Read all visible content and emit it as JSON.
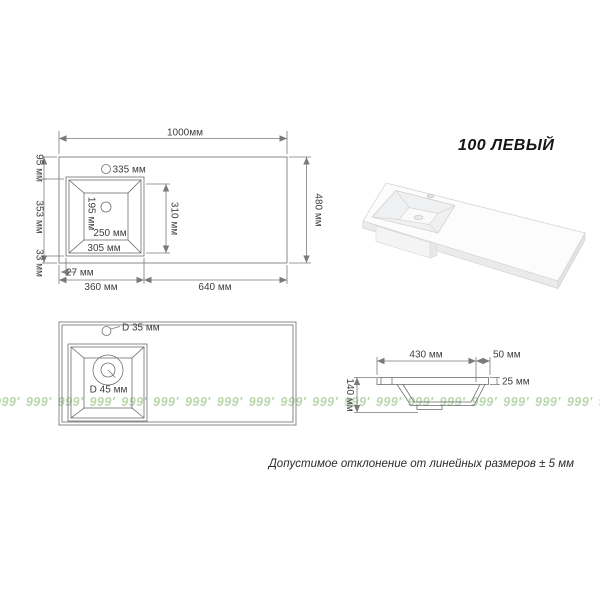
{
  "title": "100 ЛЕВЫЙ",
  "note": "Допустимое отклонение от линейных размеров ± 5 мм",
  "watermark": {
    "unit": "999′",
    "repeat": 21
  },
  "colors": {
    "line": "#6e6e6e",
    "dim": "#7a7a7a",
    "text": "#3f3f3f",
    "watermark": "#b9d8ae",
    "title": "#151515"
  },
  "plan_view": {
    "overall_width": "1000мм",
    "overall_depth": "480 мм",
    "back_margin": "95 мм",
    "basin_outer_length": "353 мм",
    "front_margin": "33 мм",
    "faucet_hole_offset": "335 мм",
    "basin_bottom_depth": "195 мм",
    "basin_bottom_width": "250 мм",
    "basin_rim_width": "305 мм",
    "basin_inner_length": "310 мм",
    "side_margin": "27 мм",
    "basin_zone_width": "360 мм",
    "counter_zone_width": "640 мм"
  },
  "holes_view": {
    "faucet_hole_diameter": "D 35 мм",
    "drain_hole_diameter": "D 45 мм"
  },
  "section_view": {
    "basin_top_width": "430 мм",
    "edge_offset": "50 мм",
    "slab_thickness": "25 мм",
    "total_height": "140 мм"
  }
}
